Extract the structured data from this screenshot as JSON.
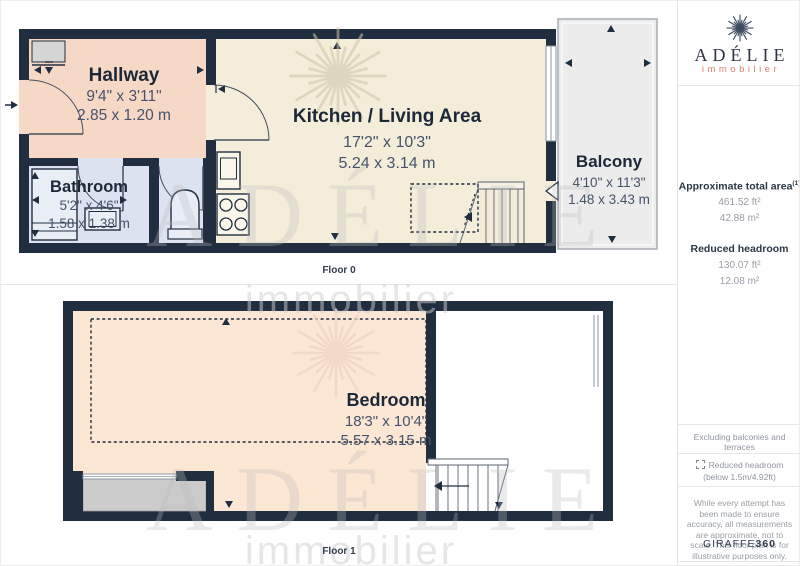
{
  "floor0": {
    "label": "Floor 0",
    "hallway": {
      "name": "Hallway",
      "imperial": "9'4\" x 3'11\"",
      "metric": "2.85 x 1.20 m"
    },
    "bathroom": {
      "name": "Bathroom",
      "imperial": "5'2\" x 4'6\"",
      "metric": "1.58 x 1.38 m"
    },
    "kitchen": {
      "name": "Kitchen / Living Area",
      "imperial": "17'2\" x 10'3\"",
      "metric": "5.24 x 3.14 m"
    },
    "balcony": {
      "name": "Balcony",
      "imperial": "4'10\" x 11'3\"",
      "metric": "1.48 x 3.43 m"
    }
  },
  "floor1": {
    "label": "Floor 1",
    "bedroom": {
      "name": "Bedroom",
      "imperial": "18'3\" x 10'4\"",
      "metric": "5.57 x 3.15 m"
    }
  },
  "watermark": {
    "wordmark": "ADÉLIE",
    "tagline": "immobilier"
  },
  "sidebar": {
    "logo": {
      "wordmark": "ADÉLIE",
      "tagline": "immobilier",
      "icon": "snowflake-icon"
    },
    "total_area_title": "Approximate total area",
    "total_area_footnote": "(1)",
    "total_area_ft": "461.52 ft²",
    "total_area_m": "42.88 m²",
    "headroom_title": "Reduced headroom",
    "headroom_ft": "130.07 ft²",
    "headroom_m": "12.08 m²",
    "exclusion_note": "Excluding balconies and terraces",
    "legend_label": "Reduced headroom",
    "legend_sublabel": "(below 1.5m/4.92ft)",
    "disclaimer": "While every attempt has been made to ensure accuracy, all measurements are approximate, not to scale. This floor plan is for illustrative purposes only.",
    "credit_brand": "GIRAFFE",
    "credit_suffix": "360"
  },
  "colors": {
    "wall": "#212e40",
    "hallway": "#f6d8c6",
    "bathroom": "#dde2f1",
    "kitchen": "#f3edda",
    "balcony": "#ececec",
    "bedroom": "#fce6d4",
    "accent_salmon": "#dd7f6d"
  }
}
